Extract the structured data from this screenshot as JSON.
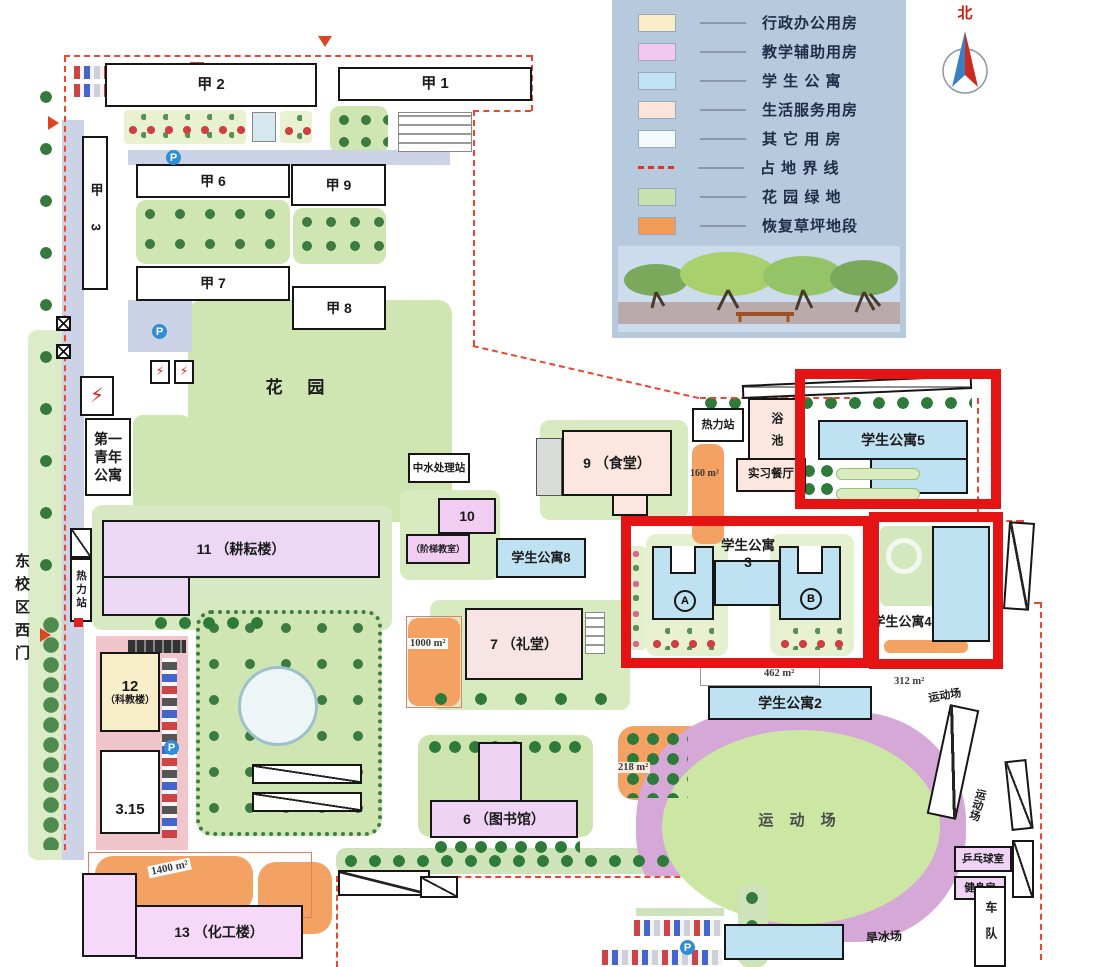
{
  "legend": {
    "items": [
      {
        "label": "行政办公用房",
        "color": "#f9edc8",
        "type": "swatch"
      },
      {
        "label": "教学辅助用房",
        "color": "#f3c8ef",
        "type": "swatch"
      },
      {
        "label": "学 生 公 寓",
        "color": "#bfe3f2",
        "type": "swatch"
      },
      {
        "label": "生活服务用房",
        "color": "#fce4da",
        "type": "swatch"
      },
      {
        "label": "其 它 用 房",
        "color": "#f2fafa",
        "type": "swatch"
      },
      {
        "label": "占 地 界 线",
        "color": "#e03323",
        "type": "dash"
      },
      {
        "label": "花 园 绿 地",
        "color": "#c7e2ae",
        "type": "swatch"
      },
      {
        "label": "恢复草坪地段",
        "color": "#f29b57",
        "type": "swatch"
      }
    ]
  },
  "compass": {
    "north": "北"
  },
  "map": {
    "labels": {
      "jia1": "甲 1",
      "jia2": "甲 2",
      "jia3": "甲 3",
      "jia6": "甲 6",
      "jia7": "甲 7",
      "jia8": "甲 8",
      "jia9": "甲 9",
      "garden": "花  园",
      "youth_apartment": "第一青年公寓",
      "water_station": "中水处理站",
      "canteen": "9 （食堂）",
      "lecture_num": "10",
      "lecture_name": "（阶梯教室）",
      "dorm8": "学生公寓8",
      "b11": "11 （耕耘楼）",
      "heat_left": "热力站",
      "heat_right": "热力站",
      "west_gate": "东校区西门",
      "b12_num": "12",
      "b12_name": "（科教楼）",
      "b315": "3.15",
      "auditorium": "7 （礼堂）",
      "library": "6 （图书馆）",
      "chem": "13 （化工楼）",
      "bath": "浴池",
      "practice_restaurant": "实习餐厅",
      "dorm5": "学生公寓5",
      "dorm3_title": "学生公寓",
      "dorm3_num": "3",
      "dorm3_a": "A",
      "dorm3_b": "B",
      "dorm4": "学生公寓4",
      "dorm2": "学生公寓2",
      "sports_main": "运 动 场",
      "sports_ne": "运动场",
      "sports_e": "运动场",
      "pingpong": "乒乓球室",
      "gym": "健身房",
      "fleet": "车队",
      "skating": "旱冰场",
      "parking": "P"
    },
    "areas": {
      "a160": "160 m²",
      "a462": "462 m²",
      "a312": "312 m²",
      "a1000": "1000 m²",
      "a218": "218 m²",
      "a1400": "1400 m²"
    }
  }
}
